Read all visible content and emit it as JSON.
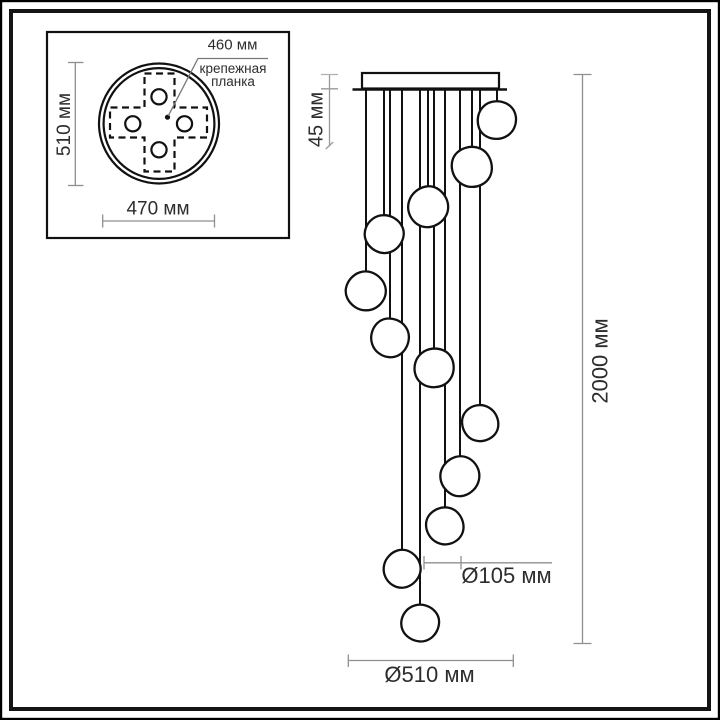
{
  "drawing": {
    "kind": "pendant-chandelier-dimension-drawing",
    "main_view": {
      "dim_canopy_height": "45 мм",
      "dim_total_height": "2000 мм",
      "dim_shade_diameter": "Ø105 мм",
      "dim_base_diameter": "Ø510 мм"
    },
    "inset_top_view": {
      "dim_vertical": "510 мм",
      "dim_horizontal": "470 мм",
      "dim_mounting": "460 мм",
      "mounting_label_line1": "крепежная",
      "mounting_label_line2": "планка"
    }
  },
  "pendants": [
    {
      "cord_x": 497,
      "globe_y": 120,
      "r": 19,
      "rot": 0
    },
    {
      "cord_x": 472,
      "globe_y": 167,
      "r": 20,
      "rot": 70
    },
    {
      "cord_x": 428,
      "globe_y": 207,
      "r": 20,
      "rot": 140
    },
    {
      "cord_x": 384,
      "globe_y": 234,
      "r": 19,
      "rot": 210
    },
    {
      "cord_x": 366,
      "globe_y": 291,
      "r": 19.5,
      "rot": 35
    },
    {
      "cord_x": 390,
      "globe_y": 338,
      "r": 19,
      "rot": 105
    },
    {
      "cord_x": 434,
      "globe_y": 368,
      "r": 19.5,
      "rot": 175
    },
    {
      "cord_x": 480,
      "globe_y": 423,
      "r": 18,
      "rot": 245
    },
    {
      "cord_x": 460,
      "globe_y": 476,
      "r": 19.5,
      "rot": 315
    },
    {
      "cord_x": 445,
      "globe_y": 526,
      "r": 18.5,
      "rot": 60
    },
    {
      "cord_x": 402,
      "globe_y": 569,
      "r": 18.5,
      "rot": 130
    },
    {
      "cord_x": 420,
      "globe_y": 623,
      "r": 18.5,
      "rot": 200
    }
  ],
  "geometry": {
    "cord_top_y": 90,
    "globe_nominal_r": 19,
    "blob_path": "M -6.2,-17.9 C 0.8,-19.9 9.5,-18.3 14.6,-12.6 C 19.2,-7.5 20.4,0.3 17.4,7.4 C 14.6,14.1 7.6,18.8 0,18.9 C -8,19 -15,15.2 -17.8,8.4 C -20.3,2.2 -19.6,-5.8 -15.4,-11.4 C -12.8,-14.9 -10.4,-16.7 -6.2,-17.9 Z"
  },
  "colors": {
    "drawing_line": "#111111",
    "dimension_line": "#8f8f8f",
    "text": "#2d2d2d",
    "background": "#ffffff"
  }
}
